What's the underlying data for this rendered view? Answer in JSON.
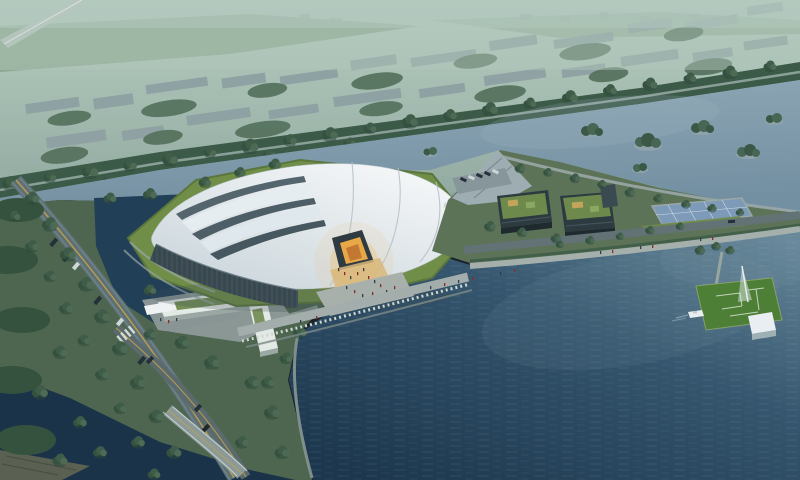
{
  "meta": {
    "description": "Aerial architectural rendering of a lakeside exhibition center at dusk",
    "view": "bird's-eye perspective, no visible text or UI elements"
  },
  "colors": {
    "sky_top": "#bdd2c6",
    "sky_low": "#8ea79e",
    "haze": "#b2c8bd",
    "field_green": "#7f9d80",
    "city_building": "#8a9ca0",
    "tree_dark": "#3f5c49",
    "tree_mid": "#4d6b54",
    "tree_deep": "#34523f",
    "belt_green": "#3c5a48",
    "belt_road": "#93a6a2",
    "water_upper_1": "#90a8b6",
    "water_upper_2": "#7390a2",
    "lake_1": "#6e8ea0",
    "lake_2": "#35566e",
    "lake_3": "#1c374e",
    "pond": "#223f58",
    "channel": "#1b3349",
    "parkland": "#4e6650",
    "lawn": "#718e49",
    "lawn_edge": "#5b763c",
    "roof_1": "#f6f8f9",
    "roof_2": "#c9d4da",
    "roof_seam": "#b5c2c9",
    "roof_slot": "#4e5e67",
    "wall": "#39474f",
    "wall_rib": "#5b6c75",
    "plaza": "#a3aeac",
    "steps": "#cdd6d0",
    "apron": "#d9b87a",
    "amber": "#e8a845",
    "amber_deep": "#c27832",
    "canopy": "#2e3b42",
    "road": "#5f7073",
    "road_line": "#c2a24e",
    "bridge": "#8b9a98",
    "deck": "#9dadb2",
    "dark_building": "#2d3b41",
    "glass": "#51646b",
    "green_roof": "#6d8a4c",
    "roof_patch": "#c2a45a",
    "panels": "#7d9ab8",
    "pier_lawn": "#4d7f36",
    "pavilion": "#e8eef2",
    "boat": "#e8eef0",
    "people_red": "#8a2c2c",
    "people_dark": "#323d46",
    "car": "#24303a",
    "bus": "#cfd6d8",
    "white_bldg": "#e3eae6",
    "gatehouse_roof": "#6f8a4f"
  },
  "objects": [
    {
      "name": "exhibition-hall",
      "label": "White tensile-roof exhibition hall"
    },
    {
      "name": "hall-entrance",
      "label": "Amber-lit triangular entrance canopy"
    },
    {
      "name": "lakeside-promenade",
      "label": "Stepped waterfront promenade"
    },
    {
      "name": "main-lake",
      "label": "Large dark lake with ripples"
    },
    {
      "name": "upper-lake",
      "label": "Upper lake with wooded islands"
    },
    {
      "name": "pond-west",
      "label": "West pond with tree reflections"
    },
    {
      "name": "canal-channel",
      "label": "Dark canal under road bridge"
    },
    {
      "name": "tree-belt",
      "label": "Tree-lined embankment road"
    },
    {
      "name": "city-district",
      "label": "Distant low-rise city blocks in haze"
    },
    {
      "name": "office-cluster",
      "label": "Green-roof office buildings with parking"
    },
    {
      "name": "wedge-pier",
      "label": "Wedge-shaped ramp pier"
    },
    {
      "name": "solar-deck",
      "label": "Solar-panel pool deck"
    },
    {
      "name": "lawn-pier",
      "label": "Square lawn pier with light mast"
    },
    {
      "name": "pavilion",
      "label": "White waterside pavilion"
    },
    {
      "name": "boat",
      "label": "Small white boat"
    },
    {
      "name": "gatehouse",
      "label": "L-shaped green-roof gatehouse"
    },
    {
      "name": "road-bridge",
      "label": "Road bridge over canal"
    },
    {
      "name": "avenue",
      "label": "Tree-lined avenue with vehicles"
    },
    {
      "name": "visitors",
      "label": "Pedestrians on plaza and promenade"
    },
    {
      "name": "vehicles",
      "label": "Cars and shuttle bus"
    }
  ]
}
